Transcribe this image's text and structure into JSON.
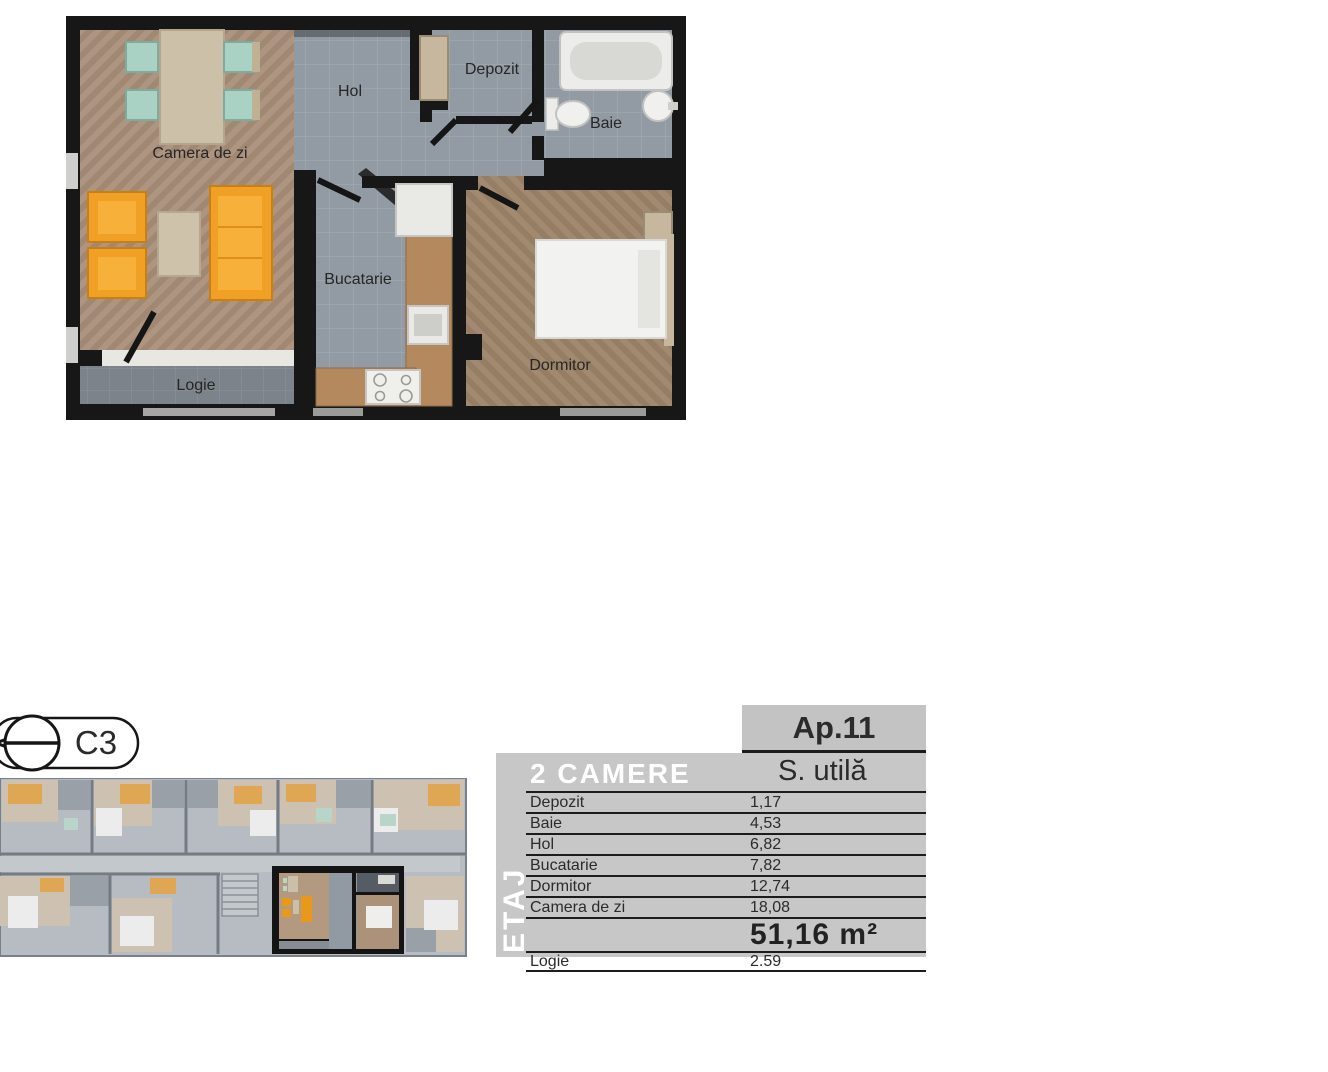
{
  "plan_labels": {
    "living": "Camera de zi",
    "hall": "Hol",
    "storage": "Depozit",
    "bathroom": "Baie",
    "kitchen": "Bucatarie",
    "bedroom": "Dormitor",
    "loggia": "Logie"
  },
  "site": {
    "section_marker": "C3"
  },
  "area_table": {
    "apartment_label": "Ap.11",
    "type_label": "2 CAMERE",
    "area_column_label": "S. utilă",
    "floor_label": "ETAJ",
    "rows": [
      {
        "label": "Depozit",
        "value": "1,17"
      },
      {
        "label": "Baie",
        "value": "4,53"
      },
      {
        "label": "Hol",
        "value": "6,82"
      },
      {
        "label": "Bucatarie",
        "value": "7,82"
      },
      {
        "label": "Dormitor",
        "value": "12,74"
      },
      {
        "label": "Camera de zi",
        "value": "18,08"
      }
    ],
    "total_value": "51,16 m²",
    "balcony_row": {
      "label": "Logie",
      "value": "2.59"
    }
  },
  "colors": {
    "wall_black": "#171717",
    "wood_living": "#ae9581",
    "wood_bedroom": "#a28a70",
    "tile_gray": "#929aa3",
    "tile_loggia": "#7d838a",
    "sofa_orange": "#f0a125",
    "chair_teal": "#a9d2c5",
    "counter_cork": "#b4895e",
    "fixture_white": "#efefec",
    "table_panel_gray": "#c7c7c7",
    "table_header_gray": "#c3c3c3",
    "table_line": "#1c1c1c",
    "text_dark": "#2b2b2b",
    "text_white": "#ffffff"
  }
}
